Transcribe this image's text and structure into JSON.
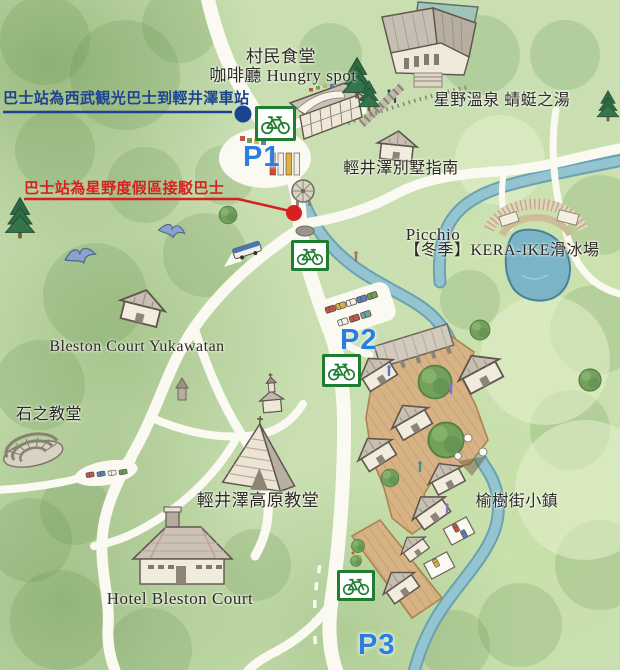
{
  "map": {
    "labels": {
      "dining_hall": "村民食堂",
      "cafe": "咖啡廳 Hungry spot",
      "onsen": "星野溫泉 蜻蜓之湯",
      "villa_guide": "輕井澤別墅指南",
      "picchio": "Picchio",
      "skating_rink": "【冬季】KERA-IKE滑冰場",
      "yukawatan": "Bleston Court Yukawatan",
      "stone_church": "石之教堂",
      "kogen_church": "輕井澤高原教堂",
      "hotel": "Hotel Bleston Court",
      "harunire_street": "榆樹街小鎮"
    },
    "annotations": {
      "seibu_bus": "巴士站為西武観光巴士到輕井澤車站",
      "shuttle_bus": "巴士站為星野度假區接駁巴士"
    },
    "parking": {
      "p1": "P1",
      "p2": "P2",
      "p3": "P3"
    },
    "icons": {
      "bicycle": "bicycle-icon"
    },
    "colors": {
      "seibu_blue": "#1b4390",
      "shuttle_red": "#d7211e",
      "parking_blue": "#2a7ede",
      "bicycle_green": "#1e7d2f"
    }
  }
}
